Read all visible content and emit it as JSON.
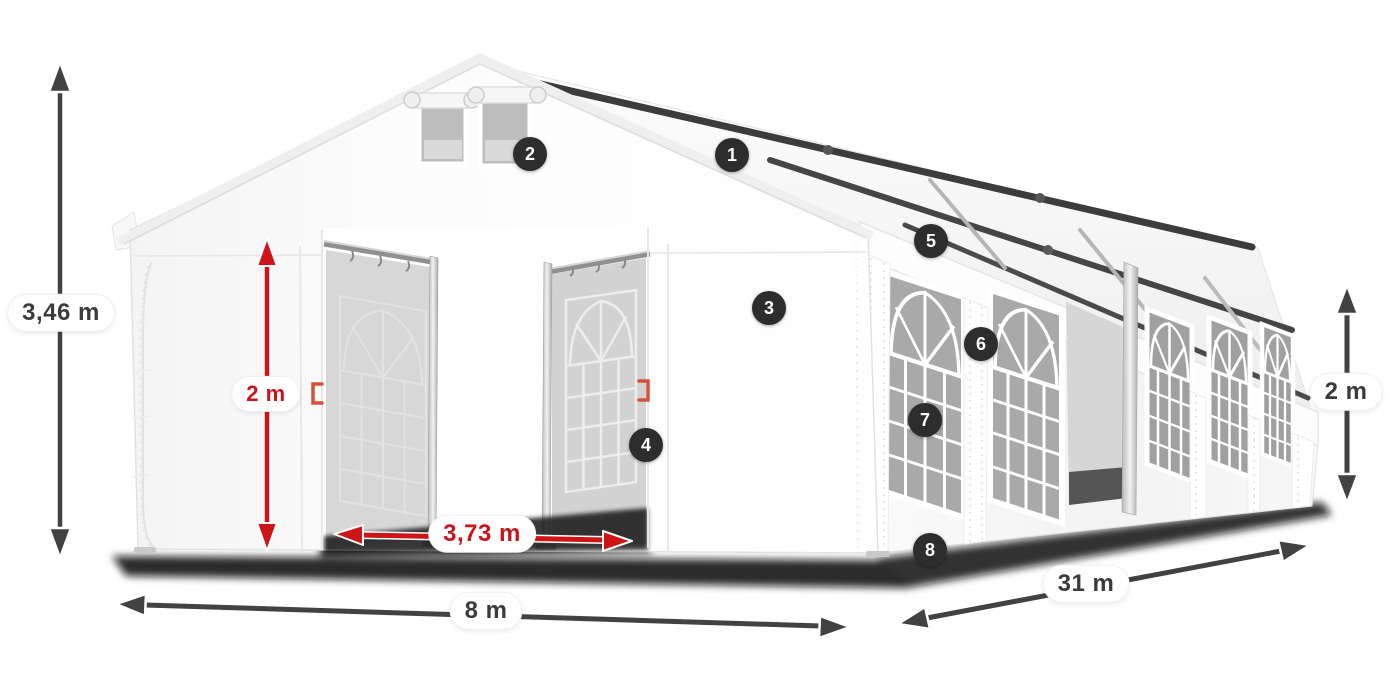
{
  "diagram": {
    "kind": "marquee-tent-dimension-illustration",
    "dimensions": {
      "total_height": {
        "label": "3,46 m",
        "style": "dark"
      },
      "clear_height": {
        "label": "2 m",
        "style": "red"
      },
      "entrance_width": {
        "label": "3,73 m",
        "style": "red"
      },
      "width": {
        "label": "8 m",
        "style": "dark"
      },
      "length": {
        "label": "31 m",
        "style": "dark"
      },
      "side_height": {
        "label": "2 m",
        "style": "dark"
      }
    },
    "callouts": [
      {
        "number": "1"
      },
      {
        "number": "2"
      },
      {
        "number": "3"
      },
      {
        "number": "4"
      },
      {
        "number": "5"
      },
      {
        "number": "6"
      },
      {
        "number": "7"
      },
      {
        "number": "8"
      }
    ],
    "colors": {
      "accent_red": "#c9161d",
      "arrow_dark": "#3e3e3e",
      "badge_bg": "#2d2d2d",
      "badge_text": "#ffffff",
      "pill_bg": "#ffffff"
    }
  }
}
